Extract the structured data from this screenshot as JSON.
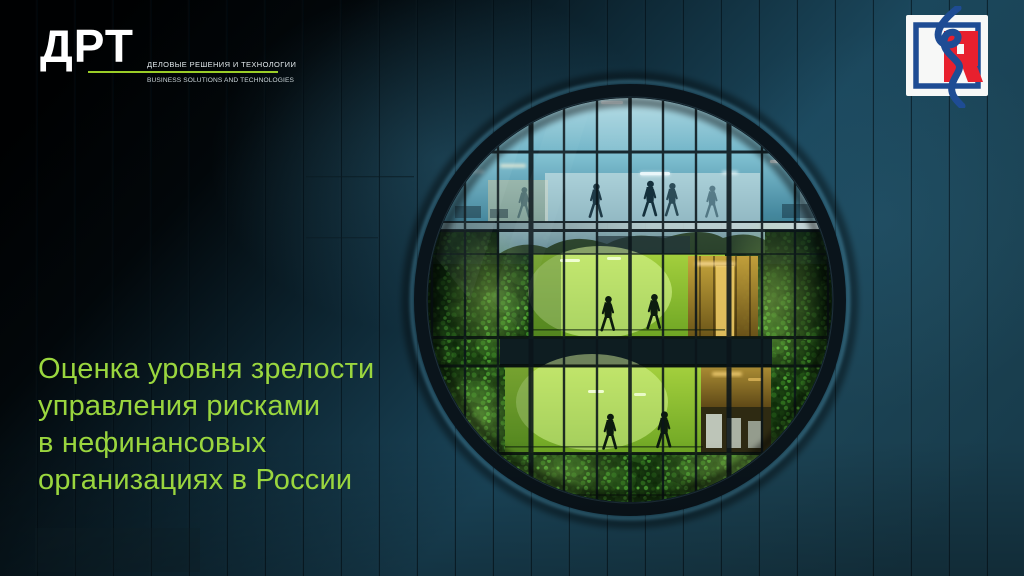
{
  "slide": {
    "title_lines": [
      "Оценка уровня зрелости",
      "управления рисками",
      "в нефинансовых",
      "организациях в России"
    ],
    "title_color": "#9ad63e"
  },
  "header": {
    "drt_logo": {
      "acronym": "ДРТ",
      "tagline_ru": "ДЕЛОВЫЕ РЕШЕНИЯ И ТЕХНОЛОГИИ",
      "tagline_en": "BUSINESS SOLUTIONS AND TECHNOLOGIES",
      "underline_color": "#9acd27"
    },
    "rusrisk_logo": {
      "glyph": "R",
      "red": "#e8202e",
      "blue": "#1e4c94"
    }
  },
  "illustration": {
    "alt": "Round window in dark teal panelled facade showing lit office floors, walking silhouettes and living green walls",
    "facade_color": "#1b4253",
    "interior_blue": "#7fc0d2",
    "interior_green": "#8fc32e"
  }
}
